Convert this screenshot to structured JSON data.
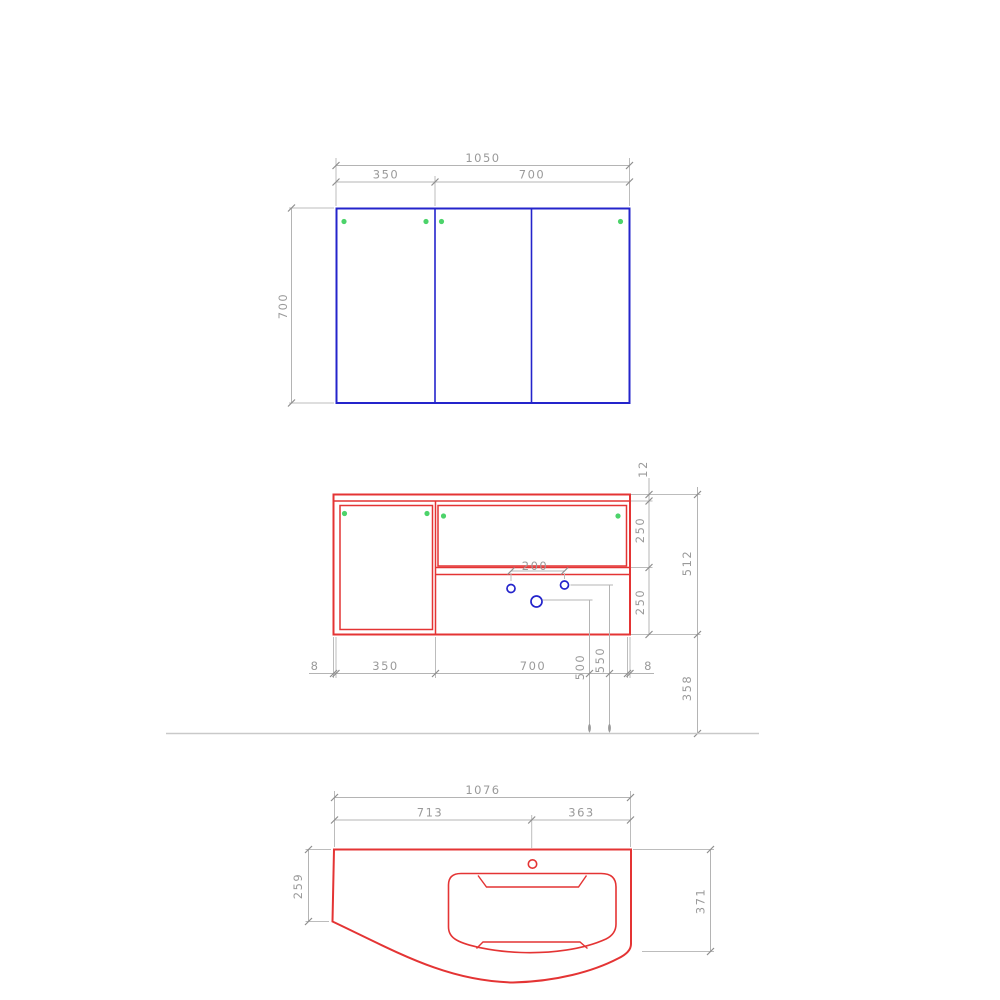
{
  "drawing_title": "bathroom-vanity-technical-drawing",
  "colors": {
    "cabinet_outline_blue": "#2424cb",
    "cabinet_outline_red": "#e43434",
    "hinge_dot_green": "#4cd36a",
    "hole_circle_blue": "#2424cb",
    "dimension_gray": "#9a9a9a",
    "floor_line_gray": "#c9c9c9"
  },
  "mirror_view": {
    "width_total": "1050",
    "width_left": "350",
    "width_right": "700",
    "height": "700"
  },
  "vanity_view": {
    "top_thickness": "12",
    "upper_section": "250",
    "lower_section": "250",
    "height_total": "512",
    "floor_clearance": "358",
    "gap_left": "8",
    "door_left": "350",
    "section_right": "700",
    "gap_right": "8",
    "hole_spacing": "200",
    "hole_height_a": "500",
    "hole_height_b": "550"
  },
  "basin_view": {
    "width_total": "1076",
    "width_left": "713",
    "width_right": "363",
    "depth_left": "259",
    "depth_right": "371"
  }
}
